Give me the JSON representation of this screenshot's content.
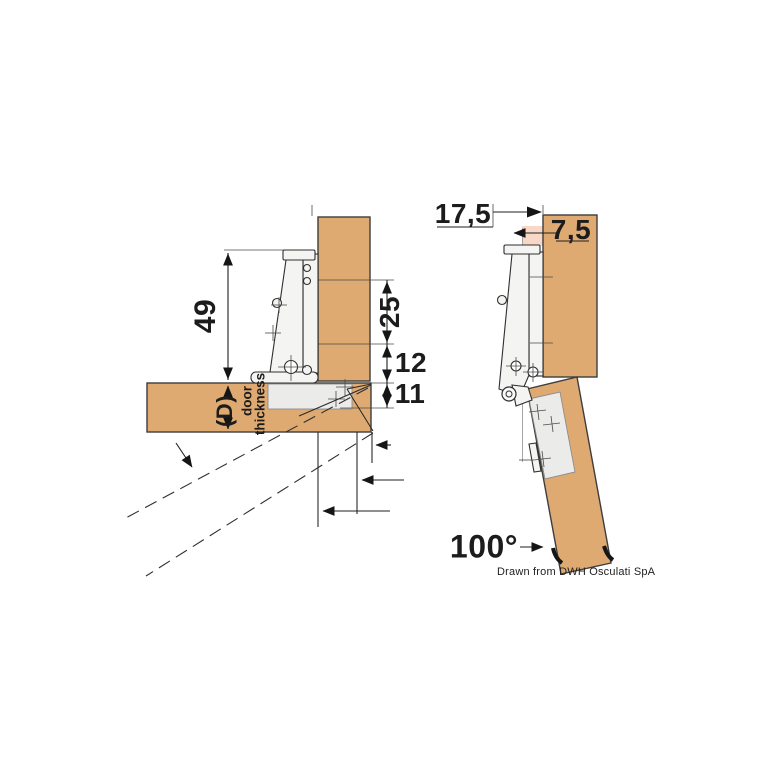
{
  "left_view": {
    "dim_height": "49",
    "dim_plate": "25",
    "dim_gap": "12",
    "dim_cup_depth": "11",
    "door_thickness_symbol": "(D)",
    "door_word": "door",
    "thickness_word": "thickness"
  },
  "right_view": {
    "dim_offset": "17,5",
    "dim_reveal": "7,5",
    "opening_angle": "100°"
  },
  "credit": "Drawn from DWH Osculati SpA",
  "colors": {
    "wood": "#dfaa72",
    "cup": "#ebebe9",
    "hinge": "#f4f4f2",
    "pink": "#f7d8c6",
    "line": "#2b2b2b"
  }
}
